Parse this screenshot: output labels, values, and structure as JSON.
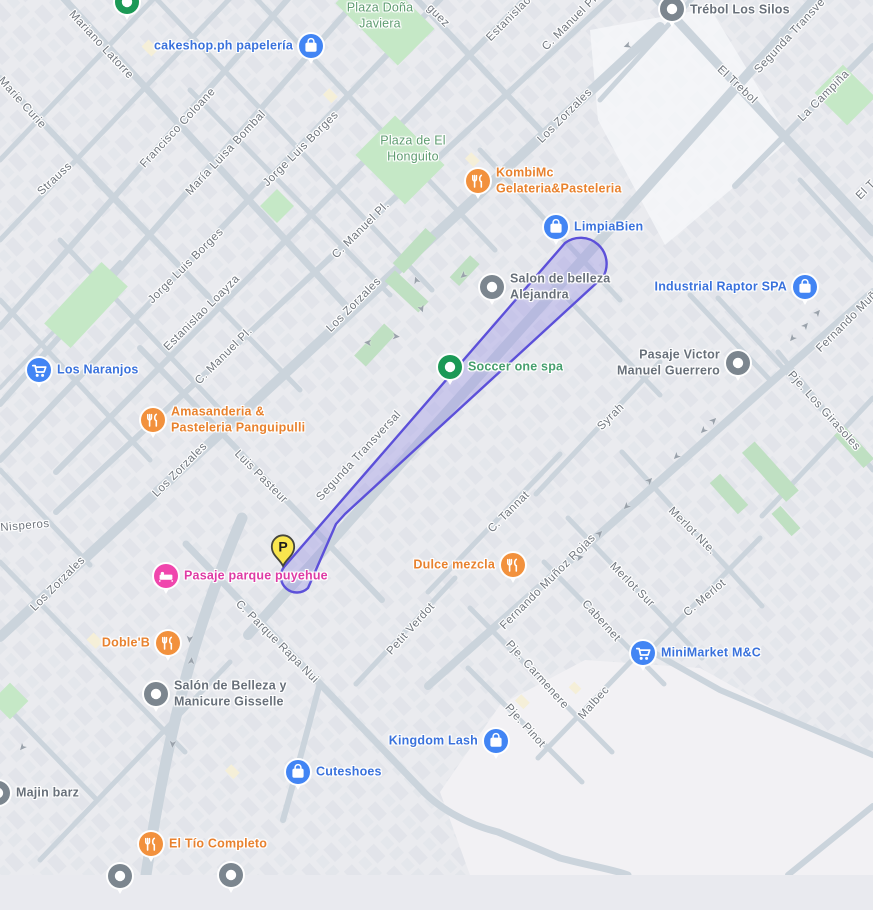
{
  "map": {
    "type": "google-maps-tile-view",
    "arrow_glyph": "➤",
    "parking_marker": {
      "label": "P",
      "x": 283,
      "y": 549
    },
    "highlight": {
      "name": "selected-area",
      "stroke": "#5C50D9",
      "fill": "rgba(147,138,230,0.35)"
    },
    "colors": {
      "poi_blue": "#3A72DC",
      "poi_blue_icon": "#4285F4",
      "poi_orange": "#E8822F",
      "poi_orange_icon": "#F2913D",
      "poi_pink": "#DE3BA5",
      "poi_pink_icon": "#F046AD",
      "poi_green": "#469F6E",
      "poi_green_icon": "#1C9956",
      "poi_gray": "#68707A",
      "poi_gray_icon": "#7C868F",
      "street_text": "#70767E",
      "road": "#CBD4DC",
      "park": "#C5E8C6",
      "hedge": "#BFE0C2",
      "background": "#E9EAEF",
      "empty_area": "#F2F1F4",
      "parking_yellow": "#F9E64E"
    },
    "street_labels": [
      {
        "t": "Mariano Latorre",
        "x": 101,
        "y": 45,
        "r": 47
      },
      {
        "t": "Marie Curie",
        "x": 22,
        "y": 103,
        "r": 48
      },
      {
        "t": "Strauss",
        "x": 55,
        "y": 179,
        "r": -43
      },
      {
        "t": "Francisco Coloane",
        "x": 178,
        "y": 128,
        "r": -47
      },
      {
        "t": "María Luisa Bombal",
        "x": 226,
        "y": 153,
        "r": -47
      },
      {
        "t": "Jorge Luis Borges",
        "x": 301,
        "y": 149,
        "r": -45
      },
      {
        "t": "Jorge Luis Borges",
        "x": 186,
        "y": 266,
        "r": -45
      },
      {
        "t": "Estanislao Loayza",
        "x": 202,
        "y": 313,
        "r": -45
      },
      {
        "t": "Estanislao",
        "x": 509,
        "y": 19,
        "r": -45
      },
      {
        "t": "C. Manuel Pl.",
        "x": 571,
        "y": 22,
        "r": -45
      },
      {
        "t": "C. Manuel Pl.",
        "x": 361,
        "y": 230,
        "r": -45
      },
      {
        "t": "C. Manuel Pl.",
        "x": 224,
        "y": 356,
        "r": -45
      },
      {
        "t": "Los Zorzales",
        "x": 565,
        "y": 116,
        "r": -45
      },
      {
        "t": "Los Zorzales",
        "x": 354,
        "y": 305,
        "r": -45
      },
      {
        "t": "Los Zorzales",
        "x": 180,
        "y": 470,
        "r": -45
      },
      {
        "t": "Los Zorzales",
        "x": 58,
        "y": 584,
        "r": -45
      },
      {
        "t": "Luis Pasteur",
        "x": 261,
        "y": 477,
        "r": 45
      },
      {
        "t": "Segunda Transversal",
        "x": 359,
        "y": 456,
        "r": -47
      },
      {
        "t": "Segunda Transve",
        "x": 790,
        "y": 36,
        "r": -47
      },
      {
        "t": "El Trebol",
        "x": 737,
        "y": 85,
        "r": 43
      },
      {
        "t": "El T",
        "x": 866,
        "y": 190,
        "r": -45
      },
      {
        "t": "La Campiña",
        "x": 824,
        "y": 96,
        "r": -45
      },
      {
        "t": "Nisperos",
        "x": 25,
        "y": 526,
        "r": -5
      },
      {
        "t": "C. Parque Rapa Nui",
        "x": 277,
        "y": 642,
        "r": 45
      },
      {
        "t": "Fernando Muñoz Rojas",
        "x": 548,
        "y": 582,
        "r": -45
      },
      {
        "t": "Fernando Muñ",
        "x": 847,
        "y": 322,
        "r": -45
      },
      {
        "t": "Syrah",
        "x": 611,
        "y": 417,
        "r": -45
      },
      {
        "t": "C. Tannat",
        "x": 509,
        "y": 512,
        "r": -45
      },
      {
        "t": "Merlot Nte.",
        "x": 692,
        "y": 531,
        "r": 45
      },
      {
        "t": "Merlot Sur",
        "x": 632,
        "y": 585,
        "r": 45
      },
      {
        "t": "C. Merlot",
        "x": 705,
        "y": 598,
        "r": -40
      },
      {
        "t": "Cabernet",
        "x": 601,
        "y": 621,
        "r": 48
      },
      {
        "t": "Pje. Carmenere",
        "x": 537,
        "y": 675,
        "r": 48
      },
      {
        "t": "Pje. Pinot",
        "x": 525,
        "y": 726,
        "r": 48
      },
      {
        "t": "Malbec",
        "x": 594,
        "y": 703,
        "r": -48
      },
      {
        "t": "Petit Verdot",
        "x": 411,
        "y": 629,
        "r": -48
      },
      {
        "t": "Pje. Los Girasoles",
        "x": 824,
        "y": 411,
        "r": 48
      },
      {
        "t": "guez",
        "x": 438,
        "y": 16,
        "r": 45
      }
    ],
    "pois": [
      {
        "name": "cakeshop-ph-papeleria",
        "ix": 311,
        "iy": 46,
        "side": "right",
        "icon": "bag",
        "color": "blue",
        "lines": [
          "cakeshop.ph papelería"
        ]
      },
      {
        "name": "plaza-dona-javiera",
        "x": 380,
        "y": 16,
        "side": "none",
        "icon": null,
        "color": "plaza",
        "lines": [
          "Plaza Doña",
          "Javiera"
        ]
      },
      {
        "name": "condominio-el-trebol-los-silos",
        "ix": 672,
        "iy": 9,
        "side": "left",
        "icon": "dot",
        "color": "gray",
        "ldy": -7,
        "lines": [
          "Condominio El",
          "Trébol Los Silos"
        ]
      },
      {
        "name": "kombimc-gelateria-pasteleria",
        "ix": 478,
        "iy": 181,
        "side": "left",
        "icon": "food",
        "color": "orange",
        "lines": [
          "KombiMc",
          "Gelateria&Pasteleria"
        ]
      },
      {
        "name": "plaza-de-el-honguito",
        "x": 413,
        "y": 149,
        "side": "none",
        "icon": null,
        "color": "plaza",
        "lines": [
          "Plaza de El",
          "Honguito"
        ]
      },
      {
        "name": "limpiabien",
        "ix": 556,
        "iy": 227,
        "side": "left",
        "icon": "bag",
        "color": "blue",
        "lines": [
          "LimpiaBien"
        ]
      },
      {
        "name": "salon-de-belleza-alejandra",
        "ix": 492,
        "iy": 287,
        "side": "left",
        "icon": "dot",
        "color": "gray",
        "lines": [
          "Salon de belleza",
          "Alejandra"
        ]
      },
      {
        "name": "industrial-raptor-spa",
        "ix": 805,
        "iy": 287,
        "side": "right",
        "icon": "bag",
        "color": "blue",
        "lines": [
          "Industrial Raptor SPA"
        ]
      },
      {
        "name": "los-naranjos",
        "ix": 39,
        "iy": 370,
        "side": "left",
        "icon": "cart",
        "color": "blue",
        "lines": [
          "Los Naranjos"
        ]
      },
      {
        "name": "soccer-one-spa",
        "ix": 450,
        "iy": 367,
        "side": "left",
        "icon": "dot",
        "color": "green",
        "lines": [
          "Soccer one spa"
        ]
      },
      {
        "name": "pasaje-victor-manuel-guerrero",
        "ix": 738,
        "iy": 363,
        "side": "right",
        "icon": "dot",
        "color": "gray",
        "lines": [
          "Pasaje Victor",
          "Manuel Guerrero"
        ]
      },
      {
        "name": "amasanderia-pasteleria-panguipulli",
        "ix": 153,
        "iy": 420,
        "side": "left",
        "icon": "food",
        "color": "orange",
        "lines": [
          "Amasanderia &",
          "Pasteleria Panguipulli"
        ]
      },
      {
        "name": "dulce-mezcla",
        "ix": 513,
        "iy": 565,
        "side": "right",
        "icon": "food",
        "color": "orange",
        "lines": [
          "Dulce mezcla"
        ]
      },
      {
        "name": "pasaje-parque-puyehue",
        "ix": 166,
        "iy": 576,
        "side": "left",
        "icon": "bed",
        "color": "pink",
        "lines": [
          "Pasaje parque puyehue"
        ]
      },
      {
        "name": "doble-b",
        "ix": 168,
        "iy": 643,
        "side": "right",
        "icon": "food",
        "color": "orange",
        "lines": [
          "Doble'B"
        ]
      },
      {
        "name": "salon-de-belleza-y-manicure-gisselle",
        "ix": 156,
        "iy": 694,
        "side": "left",
        "icon": "dot",
        "color": "gray",
        "lines": [
          "Salón de Belleza y",
          "Manicure Gisselle"
        ]
      },
      {
        "name": "minimarket-mc",
        "ix": 643,
        "iy": 653,
        "side": "left",
        "icon": "cart",
        "color": "blue",
        "lines": [
          "MiniMarket M&C"
        ]
      },
      {
        "name": "kingdom-lash",
        "ix": 496,
        "iy": 741,
        "side": "right",
        "icon": "bag",
        "color": "blue",
        "lines": [
          "Kingdom Lash"
        ]
      },
      {
        "name": "cuteshoes",
        "ix": 298,
        "iy": 772,
        "side": "left",
        "icon": "bag",
        "color": "blue",
        "lines": [
          "Cuteshoes"
        ]
      },
      {
        "name": "el-tio-completo",
        "ix": 151,
        "iy": 844,
        "side": "left",
        "icon": "food",
        "color": "orange",
        "lines": [
          "El Tío Completo"
        ]
      },
      {
        "name": "majin-barz",
        "ix": -2,
        "iy": 793,
        "side": "left",
        "icon": "dot",
        "color": "gray",
        "lines": [
          "Majin barz"
        ]
      },
      {
        "name": "poi-partial-top-green",
        "ix": 127,
        "iy": 2,
        "side": "left",
        "icon": "dot",
        "color": "green",
        "lines": []
      },
      {
        "name": "poi-partial-bottom-1",
        "ix": 120,
        "iy": 876,
        "side": "left",
        "icon": "dot",
        "color": "gray",
        "lines": []
      },
      {
        "name": "poi-partial-bottom-2",
        "ix": 231,
        "iy": 875,
        "side": "left",
        "icon": "dot",
        "color": "gray",
        "lines": []
      }
    ],
    "arrows": [
      {
        "x": 627,
        "y": 45,
        "r": 160
      },
      {
        "x": 463,
        "y": 275,
        "r": 140
      },
      {
        "x": 417,
        "y": 280,
        "r": -110
      },
      {
        "x": 421,
        "y": 309,
        "r": 70
      },
      {
        "x": 368,
        "y": 342,
        "r": 185
      },
      {
        "x": 396,
        "y": 337,
        "r": 5
      },
      {
        "x": 189,
        "y": 639,
        "r": 95
      },
      {
        "x": 192,
        "y": 661,
        "r": -85
      },
      {
        "x": 172,
        "y": 744,
        "r": 95
      },
      {
        "x": 22,
        "y": 747,
        "r": 130
      },
      {
        "x": 703,
        "y": 430,
        "r": 135
      },
      {
        "x": 714,
        "y": 421,
        "r": -45
      },
      {
        "x": 676,
        "y": 456,
        "r": 135
      },
      {
        "x": 650,
        "y": 481,
        "r": -45
      },
      {
        "x": 626,
        "y": 506,
        "r": 135
      },
      {
        "x": 600,
        "y": 534,
        "r": -45
      },
      {
        "x": 580,
        "y": 558,
        "r": -10
      },
      {
        "x": 792,
        "y": 338,
        "r": 130
      },
      {
        "x": 806,
        "y": 326,
        "r": -50
      },
      {
        "x": 818,
        "y": 313,
        "r": -50
      }
    ]
  }
}
